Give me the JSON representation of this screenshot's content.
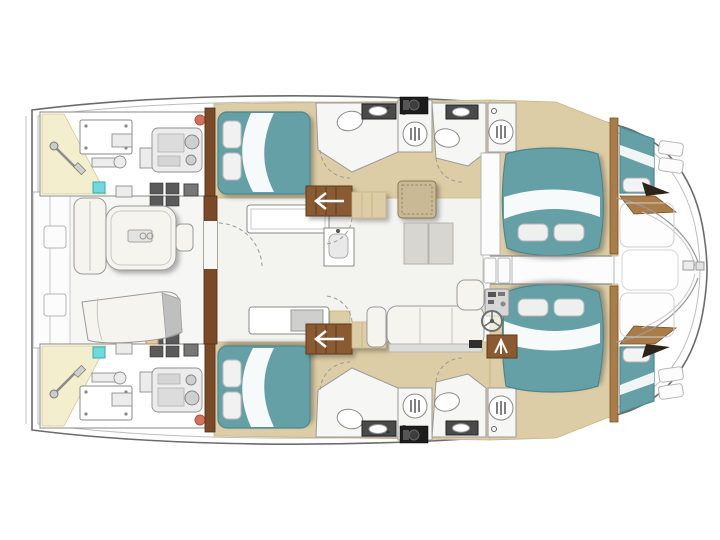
{
  "diagram": {
    "type": "floor-plan",
    "subject": "catamaran yacht deck layout, top view, bow to the right",
    "symmetry": "port and starboard hulls mirrored about centerline",
    "areas": {
      "port_hull": [
        "engine-room",
        "steering-gear-bay",
        "aft-cabin-double-berth",
        "aft-head-toilet-sink",
        "aft-shower",
        "washer-appliance",
        "fwd-head-toilet-sink",
        "fwd-shower",
        "forward-cabin-double-berth",
        "forepeak-berth"
      ],
      "starboard_hull": [
        "engine-room",
        "steering-gear-bay",
        "aft-cabin-double-berth",
        "aft-head-toilet-sink",
        "aft-shower",
        "appliance-counter",
        "fwd-head-toilet-sink",
        "fwd-shower",
        "forward-cabin-double-berth",
        "forepeak-berth"
      ],
      "bridgedeck": [
        "aft-platform",
        "aft-deck-winches",
        "cockpit-l-sofa",
        "cockpit-table",
        "cockpit-stool",
        "sun-lounger",
        "salon-sliding-door",
        "galley-counter",
        "galley-sink",
        "galley-sideboard",
        "port-companionway-stairs",
        "starboard-companionway-stairs",
        "rattan-table",
        "floor-mats",
        "salon-settee",
        "helm-console",
        "steering-wheel",
        "chart-table",
        "forward-door-steps",
        "forward-walkway",
        "foredeck-lockers",
        "bow-fitting"
      ]
    },
    "fixture_glyphs": [
      "toilet-icon",
      "sink-icon",
      "shower-drain-icon",
      "steering-wheel-icon",
      "stairs-arrow-icon",
      "engine-icon",
      "rudder-tiller-icon"
    ]
  },
  "colors": {
    "paper": "#ffffff",
    "outline": "#6b6b6b",
    "outline_light": "#bdbdbd",
    "floor_teak": "#ddcda6",
    "floor_teak_dark": "#c9b483",
    "wood_dark": "#7a4a28",
    "wood_mid": "#a97c4a",
    "bed_teal": "#66a0a7",
    "bed_teal_dark": "#4d858d",
    "cushion_white": "#f6f4ef",
    "fixture_grey": "#e4e4e4",
    "fixture_grey_dark": "#9a9a9a",
    "appliance_black": "#1d1d1d",
    "engine_grey": "#ececec",
    "steering_bay_yellow": "#f3efce",
    "accent_cyan": "#6fd9dd",
    "accent_red": "#d4705e",
    "salon_floor": "#f3f3f0",
    "mat_grey": "#d8d6d0"
  }
}
